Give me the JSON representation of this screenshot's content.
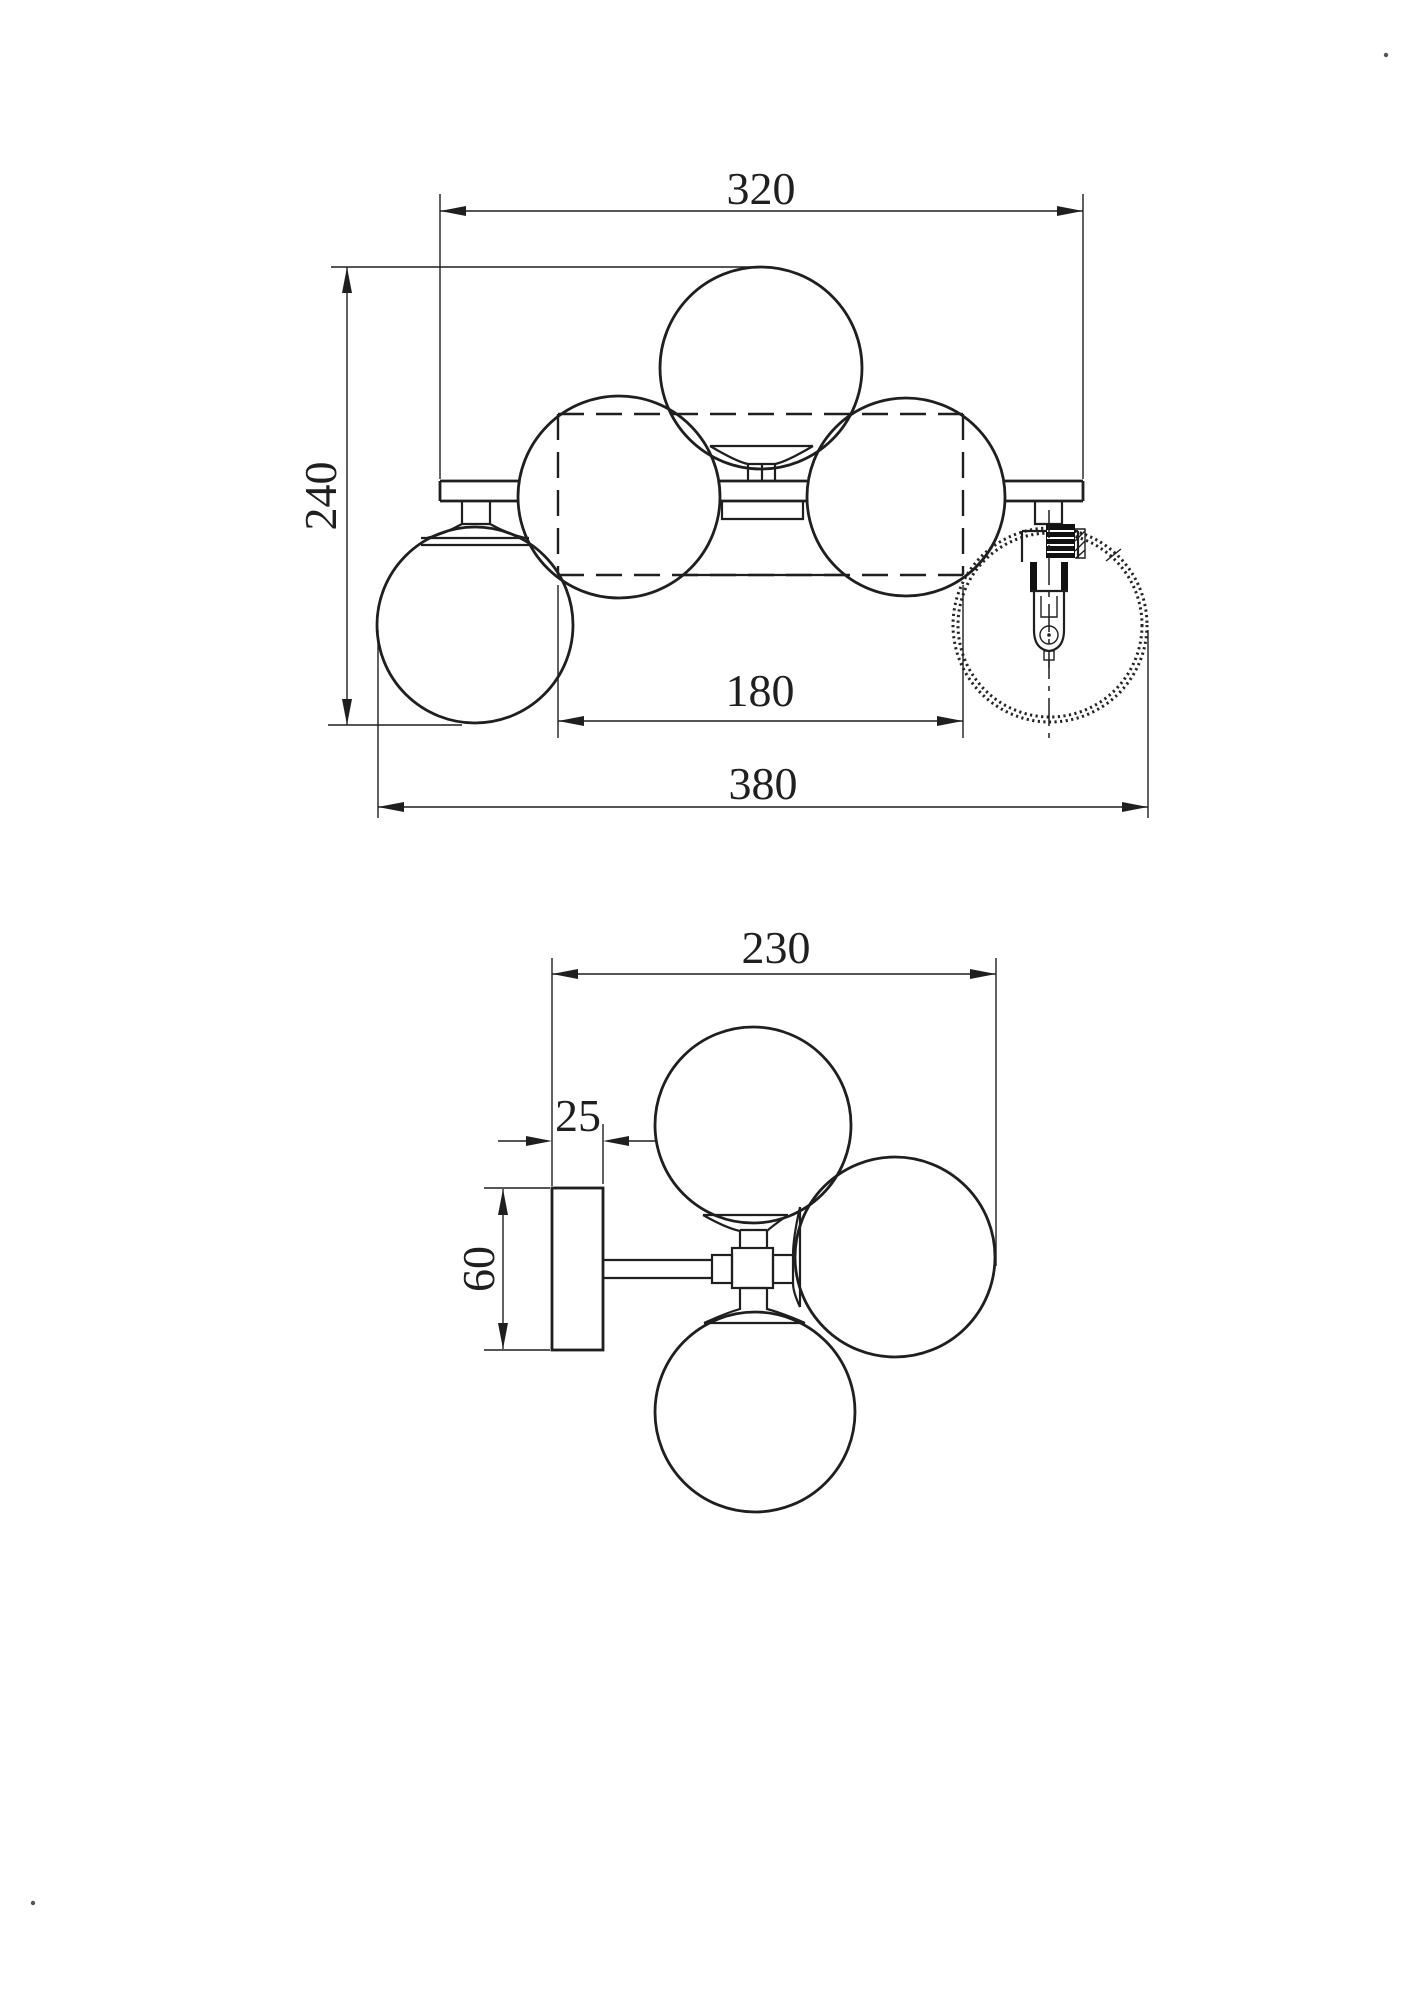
{
  "drawing": {
    "background": "#ffffff",
    "line_color": "#1f1f1f",
    "views": {
      "front": {
        "label": "front-elevation",
        "dimensions": {
          "bar_width_mm": "320",
          "overall_height_mm": "240",
          "canopy_width_mm": "180",
          "overall_width_mm": "380"
        }
      },
      "side": {
        "label": "side-elevation",
        "dimensions": {
          "overall_depth_mm": "230",
          "backplate_thickness_mm": "25",
          "backplate_height_mm": "60"
        }
      }
    }
  }
}
